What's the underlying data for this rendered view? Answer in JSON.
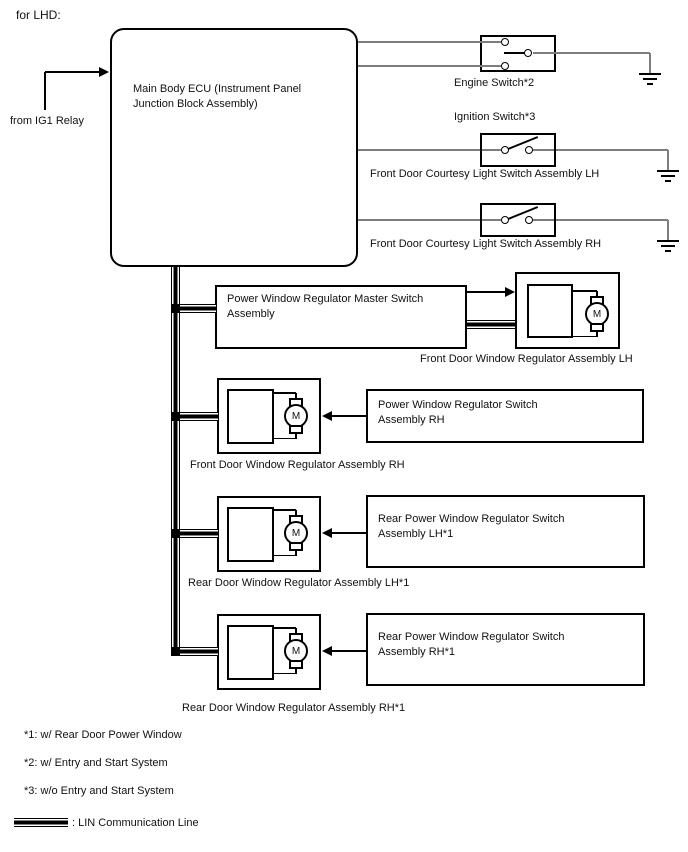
{
  "header": {
    "variant": "for LHD:"
  },
  "ecu": {
    "line1": "Main Body ECU (Instrument Panel",
    "line2": "Junction Block Assembly)",
    "source_label": "from IG1 Relay"
  },
  "circuits": {
    "engine_switch": "Engine Switch*2",
    "ignition_switch": "Ignition Switch*3",
    "courtesy_lh": "Front Door Courtesy Light Switch Assembly LH",
    "courtesy_rh": "Front Door Courtesy Light Switch Assembly RH"
  },
  "master_switch": {
    "line1": "Power Window Regulator Master Switch",
    "line2": "Assembly"
  },
  "assemblies": {
    "front_lh": "Front Door Window Regulator Assembly LH",
    "front_rh": "Front Door Window Regulator Assembly RH",
    "rear_lh": "Rear Door Window Regulator Assembly LH*1",
    "rear_rh": "Rear Door Window Regulator Assembly RH*1",
    "motor_letter": "M"
  },
  "switch_boxes": {
    "front_rh": {
      "line1": "Power Window Regulator Switch",
      "line2": "Assembly RH"
    },
    "rear_lh": {
      "line1": "Rear Power Window Regulator Switch",
      "line2": "Assembly LH*1"
    },
    "rear_rh": {
      "line1": "Rear Power Window Regulator Switch",
      "line2": "Assembly RH*1"
    }
  },
  "footnotes": {
    "n1": "*1: w/ Rear Door Power Window",
    "n2": "*2: w/ Entry and Start System",
    "n3": "*3: w/o Entry and Start System"
  },
  "legend": {
    "lin_line": ": LIN Communication Line"
  },
  "colors": {
    "wire": "#7d7d7d",
    "line": "#000000",
    "background": "#ffffff"
  }
}
